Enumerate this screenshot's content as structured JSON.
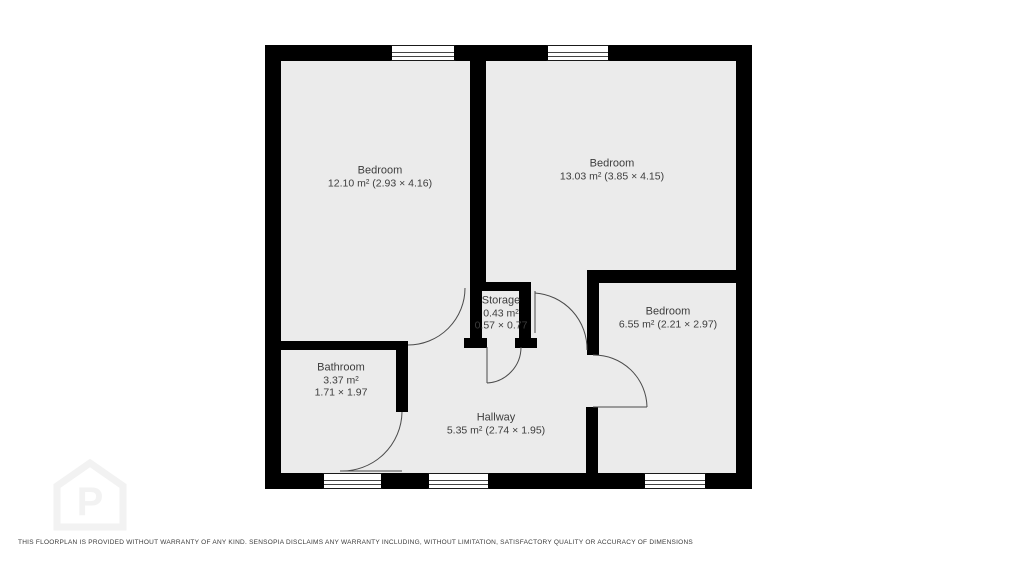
{
  "plan": {
    "rooms": [
      {
        "id": "bedroom-1",
        "name": "Bedroom",
        "line2": "12.10 m² (2.93 × 4.16)",
        "line3": ""
      },
      {
        "id": "bedroom-2",
        "name": "Bedroom",
        "line2": "13.03 m² (3.85 × 4.15)",
        "line3": ""
      },
      {
        "id": "bedroom-3",
        "name": "Bedroom",
        "line2": "6.55 m² (2.21 × 2.97)",
        "line3": ""
      },
      {
        "id": "bathroom",
        "name": "Bathroom",
        "line2": "3.37 m²",
        "line3": "1.71 × 1.97"
      },
      {
        "id": "storage",
        "name": "Storage",
        "line2": "0.43 m²",
        "line3": "0.57 × 0.77"
      },
      {
        "id": "hallway",
        "name": "Hallway",
        "line2": "5.35 m² (2.74 × 1.95)",
        "line3": ""
      }
    ],
    "colors": {
      "wall": "#000000",
      "floor": "#ebebeb",
      "label_text": "#3d3d3d",
      "watermark": "#f2f2f2"
    },
    "watermark_icon": "house-p-logo-icon",
    "disclaimer": "THIS FLOORPLAN IS PROVIDED WITHOUT WARRANTY OF ANY KIND. SENSOPIA DISCLAIMS ANY WARRANTY INCLUDING, WITHOUT LIMITATION, SATISFACTORY QUALITY OR ACCURACY OF DIMENSIONS"
  }
}
